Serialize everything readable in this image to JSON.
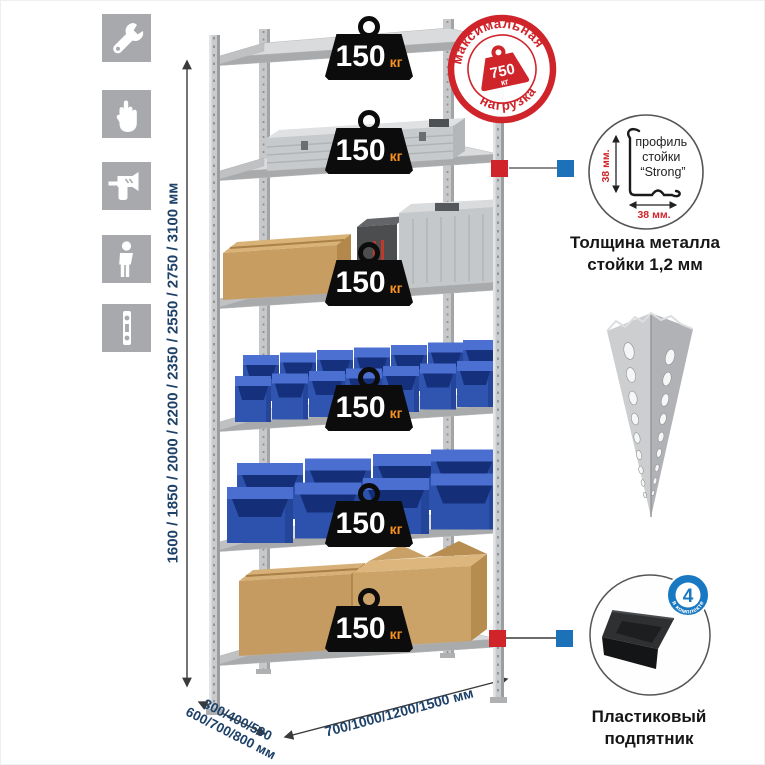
{
  "sidebar": {
    "tiles": [
      {
        "icon": "wrench-icon"
      },
      {
        "icon": "gloves-icon"
      },
      {
        "icon": "drill-icon"
      },
      {
        "icon": "person-icon"
      },
      {
        "icon": "spirit-level-icon"
      }
    ]
  },
  "dimensions": {
    "height": "1600 / 1850 / 2000 / 2200 / 2350 / 2550 / 2750 / 3100 мм",
    "depth_line1": "300/400/500",
    "depth_line2": "600/700/800 мм",
    "width": "700/1000/1200/1500 мм"
  },
  "shelf_load": {
    "value": "150",
    "unit": "кг"
  },
  "max_load_stamp": {
    "arc_top": "максимальная",
    "arc_bottom": "нагрузка",
    "value": "750",
    "unit": "кг",
    "color": "#d0242b"
  },
  "profile_callout": {
    "vertical_dim": "38 мм.",
    "horizontal_dim": "38 мм.",
    "label_l1": "профиль",
    "label_l2": "стойки",
    "label_l3": "“Strong”",
    "caption_l1": "Толщина металла",
    "caption_l2": "стойки 1,2 мм"
  },
  "foot_callout": {
    "badge_value": "4",
    "badge_arc": "в комплекте",
    "caption_l1": "Пластиковый",
    "caption_l2": "подпятник"
  },
  "colors": {
    "accent_red": "#d0242b",
    "accent_blue": "#1878c2",
    "bin_blue": "#2f55b0",
    "dim_navy": "#1d4168",
    "unit_orange": "#f79220"
  }
}
